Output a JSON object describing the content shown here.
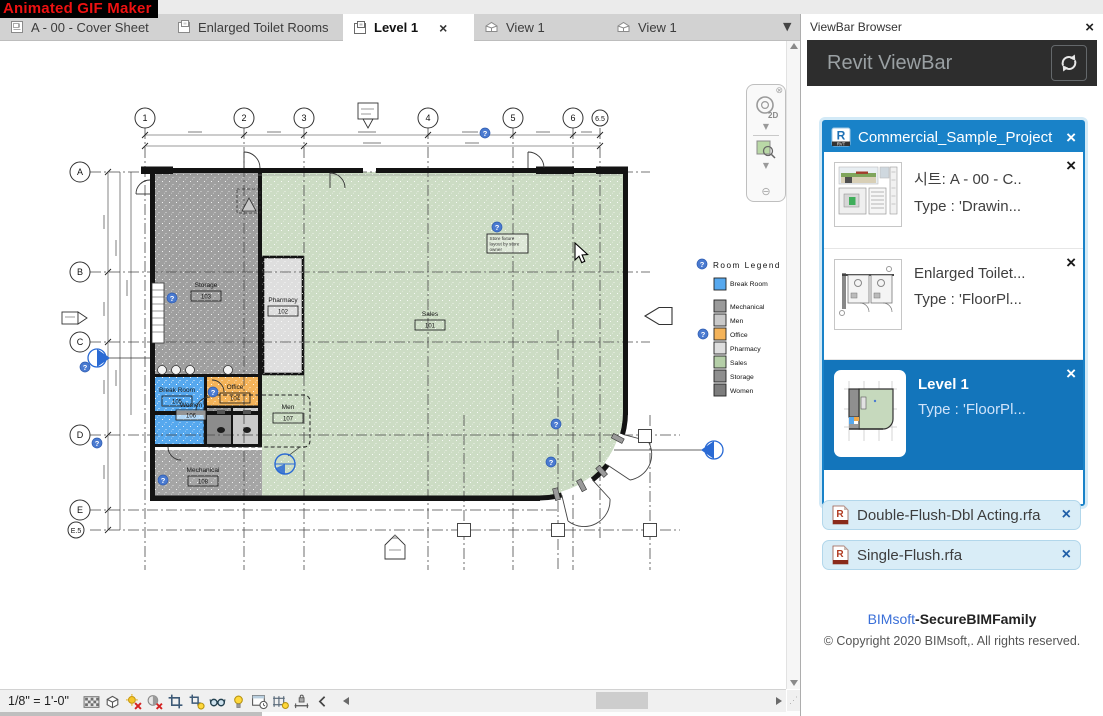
{
  "overlay": {
    "title": "Animated GIF Maker"
  },
  "tabbar": {
    "tabs": [
      {
        "label": "A - 00 - Cover Sheet"
      },
      {
        "label": "Enlarged Toilet Rooms"
      },
      {
        "label": "Level 1"
      },
      {
        "label": "View 1"
      },
      {
        "label": "View 1"
      }
    ]
  },
  "panel": {
    "title": "ViewBar Browser",
    "brand": "Revit ViewBar",
    "project": {
      "name": "Commercial_Sample_Project",
      "badge": "RVT",
      "items": [
        {
          "line1": "시트: A - 00 - C..",
          "line2": "Type : 'Drawin..."
        },
        {
          "line1": "Enlarged Toilet...",
          "line2": "Type : 'FloorPl..."
        },
        {
          "line1": "Level 1",
          "line2": "Type : 'FloorPl..."
        }
      ]
    },
    "families": [
      {
        "name": "Double-Flush-Dbl Acting.rfa"
      },
      {
        "name": "Single-Flush.rfa"
      }
    ],
    "footer": {
      "link": "BIMsoft",
      "suffix": "-SecureBIMFamily",
      "copyright": "© Copyright 2020 BIMsoft,. All rights reserved."
    }
  },
  "statusbar": {
    "scale": "1/8\" = 1'-0\""
  },
  "plan": {
    "grid_cols": [
      "1",
      "2",
      "3",
      "4",
      "5",
      "6",
      "6.5"
    ],
    "grid_rows": [
      "A",
      "B",
      "C",
      "D",
      "E",
      "E.5"
    ],
    "rooms": [
      {
        "name": "Sales",
        "number": "101",
        "color": "#ccdcc4"
      },
      {
        "name": "Pharmacy",
        "number": "102",
        "color": "#dedede"
      },
      {
        "name": "Storage",
        "number": "103",
        "color": "#9f9f9f"
      },
      {
        "name": "Office",
        "number": "104",
        "color": "#f4b359"
      },
      {
        "name": "Break Room",
        "number": "105",
        "color": "#56a8ee"
      },
      {
        "name": "Women",
        "number": "106",
        "color": "#8c8c8c"
      },
      {
        "name": "Men",
        "number": "107",
        "color": "#c9c9c9"
      },
      {
        "name": "Mechanical",
        "number": "108",
        "color": "#a5a5a5"
      }
    ],
    "legend": {
      "title": "Room Legend",
      "entries": [
        {
          "label": "Break Room",
          "color": "#56a8ee"
        },
        {
          "label": "Mechanical",
          "color": "#9a9a9a"
        },
        {
          "label": "Men",
          "color": "#c9c9c9"
        },
        {
          "label": "Office",
          "color": "#f4b359"
        },
        {
          "label": "Pharmacy",
          "color": "#dedede"
        },
        {
          "label": "Sales",
          "color": "#b5cfa8"
        },
        {
          "label": "Storage",
          "color": "#8f8f8f"
        },
        {
          "label": "Women",
          "color": "#7d7d7d"
        }
      ]
    },
    "note": {
      "line1": "Store fixture",
      "line2": "layout by store",
      "line3": "owner"
    }
  }
}
